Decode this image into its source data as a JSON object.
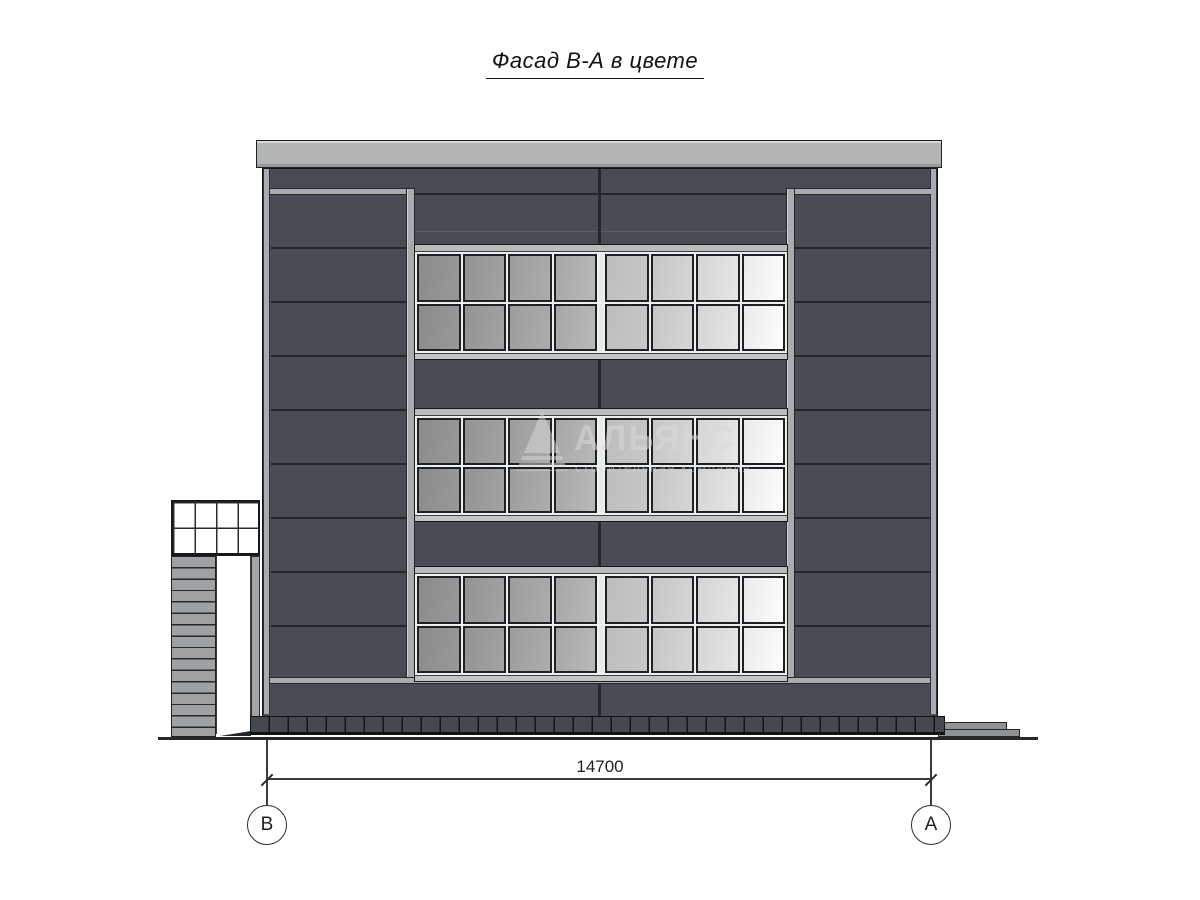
{
  "title": "Фасад В-А в цвете",
  "watermark": {
    "name": "АЛЬЯНС",
    "subtitle": "строительная компания",
    "logo": "triangle-logo"
  },
  "dimension": {
    "value": "14700"
  },
  "axes": [
    {
      "label": "В"
    },
    {
      "label": "А"
    }
  ],
  "facade": {
    "window_bands": 3,
    "window_rows": 2,
    "window_cols": 8,
    "pane_colors": [
      [
        "#8b8b8b",
        "#989898"
      ],
      [
        "#939393",
        "#a3a3a3"
      ],
      [
        "#9d9d9d",
        "#acacac"
      ],
      [
        "#a7a7a7",
        "#b9b9b9"
      ],
      [
        "#bdbdbd",
        "#c7c7c7"
      ],
      [
        "#c6c6c6",
        "#d6d6d6"
      ],
      [
        "#d5d5d5",
        "#e6e6e6"
      ],
      [
        "#eaeaea",
        "#fdfdfd"
      ]
    ],
    "colors": {
      "panel_dark": "#484c54",
      "joint_dark": "#23262b",
      "frame_light": "#a9acae",
      "parapet": "#b2b4b6",
      "plinth": "#44484f",
      "glass_frame": "#eef0f0"
    }
  }
}
